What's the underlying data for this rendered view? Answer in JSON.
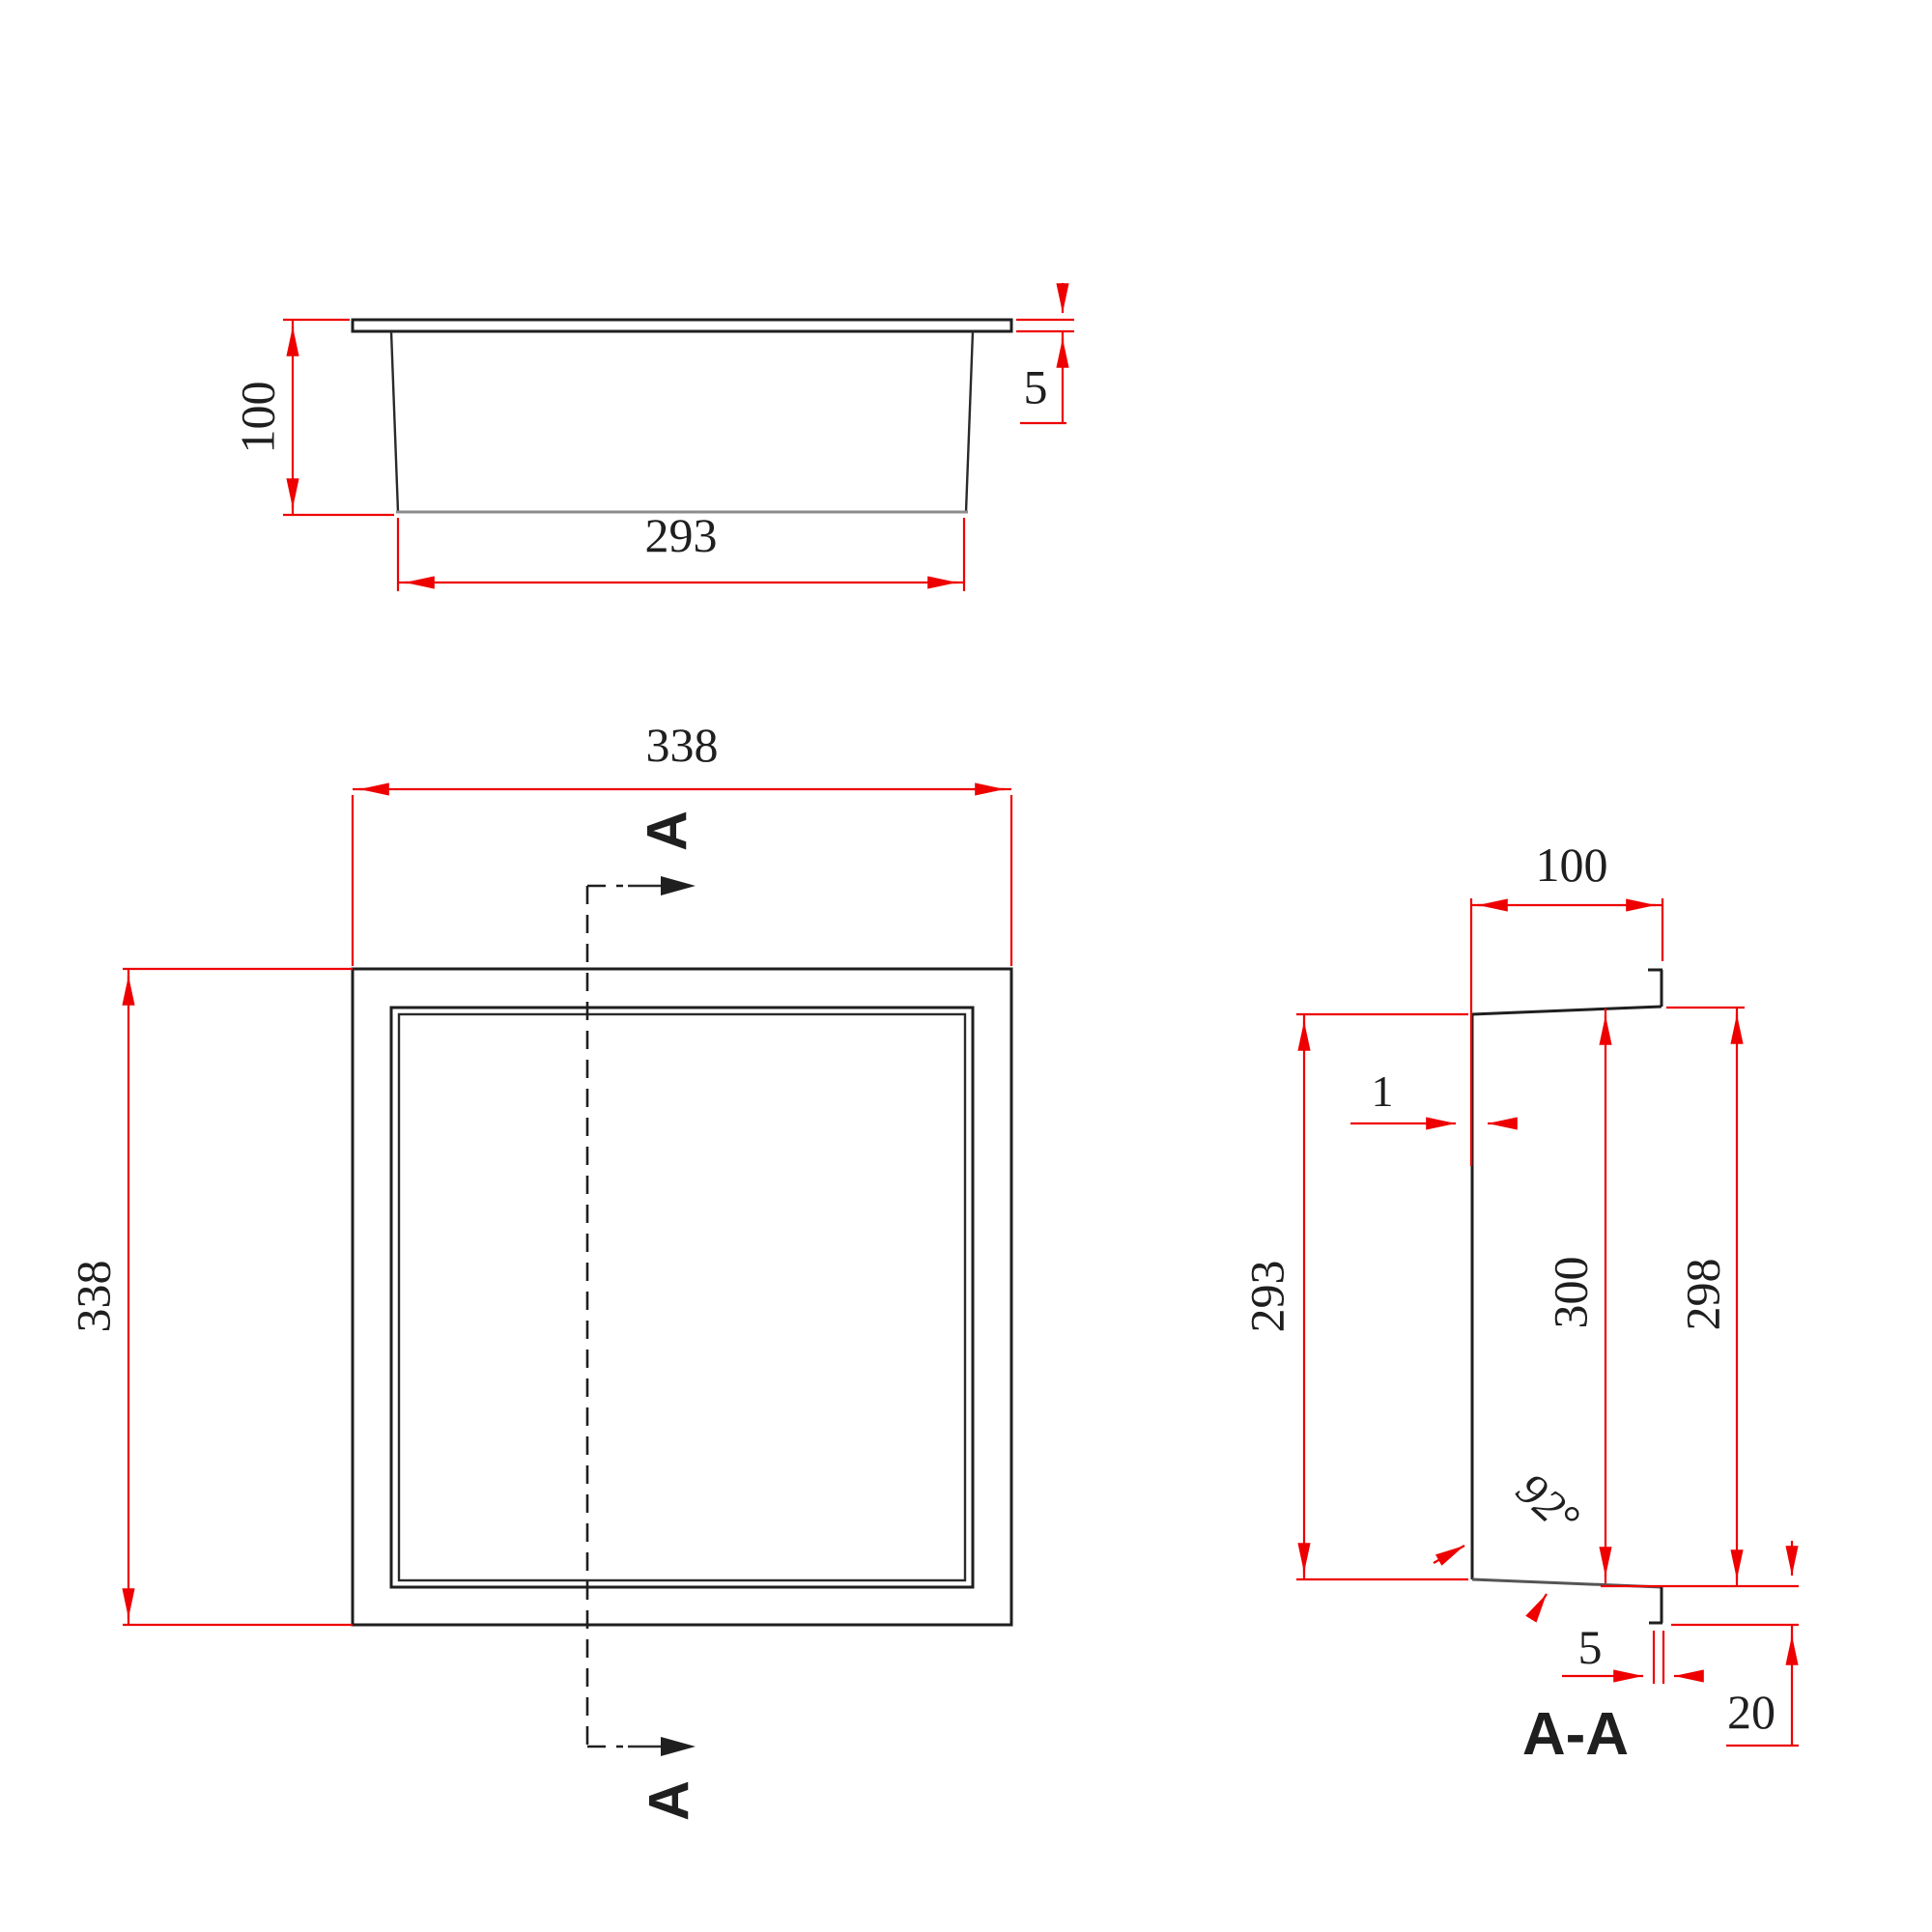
{
  "drawing": {
    "background_color": "#ffffff",
    "outline_color": "#1f1f1f",
    "dimension_color": "#ee0000",
    "hidden_edge_color": "#8c8c8c",
    "top_view": {
      "height_dim": "100",
      "flange_thickness_dim": "5",
      "bottom_width_dim": "293"
    },
    "plan_view": {
      "width_dim": "338",
      "height_dim": "338",
      "section_letter_top": "A",
      "section_letter_bottom": "A"
    },
    "section_view": {
      "title": "A-A",
      "depth_dim": "100",
      "wall_thickness_dim": "1",
      "back_height_dim": "293",
      "inner_height_dim": "300",
      "front_height_dim": "298",
      "angle_dim": "92°",
      "lip_gap_dim": "5",
      "lip_length_dim": "20"
    }
  }
}
